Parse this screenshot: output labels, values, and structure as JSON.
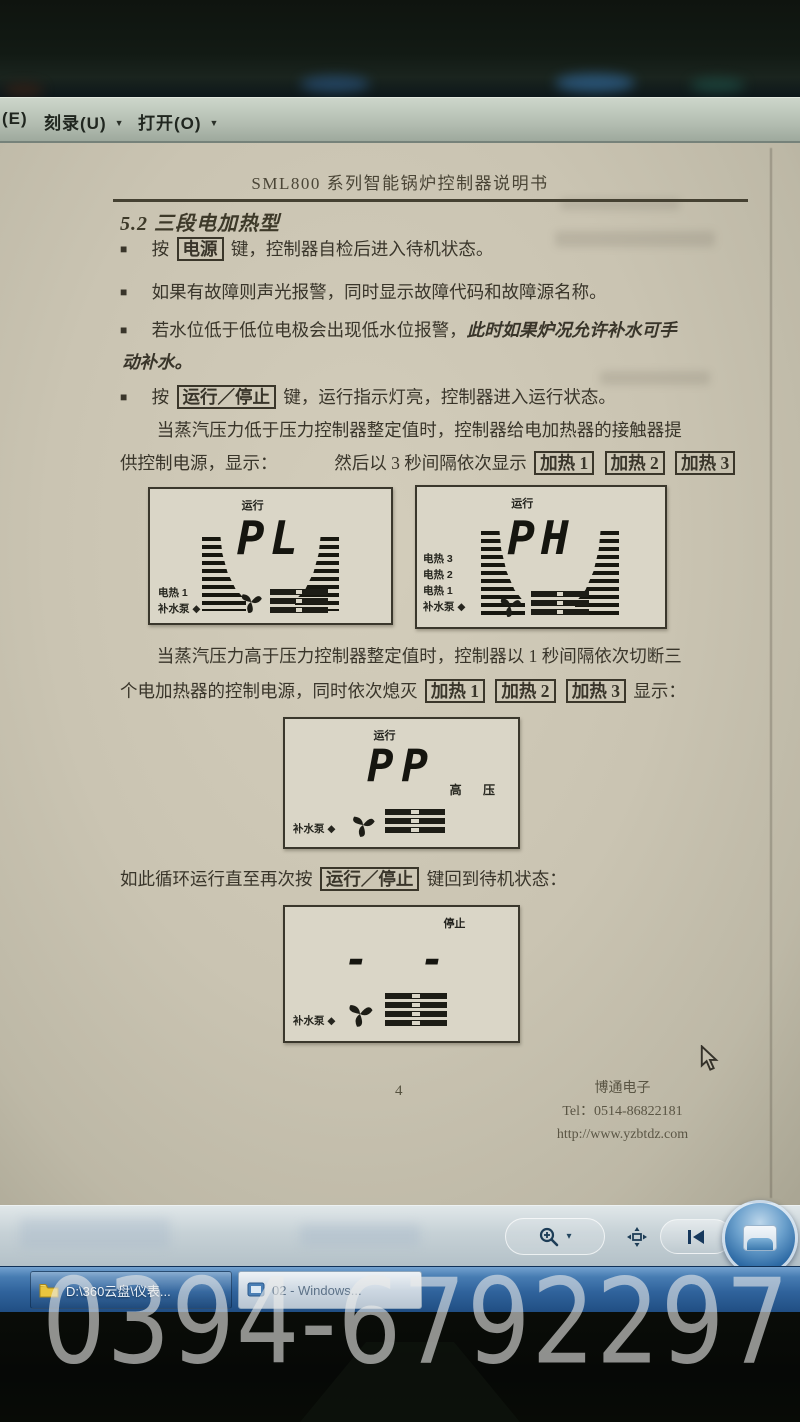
{
  "watermark": {
    "text": "0394-6792297"
  },
  "menu_bar": {
    "edge_item": "(E)",
    "caret": "▼",
    "items": [
      {
        "label": "刻录(U)"
      },
      {
        "label": "打开(O)"
      }
    ]
  },
  "document": {
    "bullet_marker": "■",
    "header_title": "SML800 系列智能锅炉控制器说明书",
    "section_heading": "5.2 三段电加热型",
    "bullets": [
      {
        "pre": "按",
        "key": "电源",
        "post": "键，控制器自检后进入待机状态。"
      },
      {
        "text": "如果有故障则声光报警，同时显示故障代码和故障源名称。"
      },
      {
        "text": "若水位低于低位电极会出现低水位报警，",
        "emph1": "此时如果炉况允许补水可手",
        "emph2": "动补水。"
      },
      {
        "pre": "按",
        "key": "运行／停止",
        "post": "键，运行指示灯亮，控制器进入运行状态。"
      }
    ],
    "heat_keys": [
      "加热 1",
      "加热 2",
      "加热 3"
    ],
    "para1": {
      "line1": "当蒸汽压力低于压力控制器整定值时，控制器给电加热器的接触器提",
      "line2_pre": "供控制电源，显示：",
      "line2_mid": "然后以 3 秒间隔依次显示"
    },
    "para2": {
      "line1": "当蒸汽压力高于压力控制器整定值时，控制器以 1 秒间隔依次切断三",
      "line2_pre": "个电加热器的控制电源，同时依次熄灭",
      "line2_post": "显示："
    },
    "para3": {
      "pre": "如此循环运行直至再次按",
      "key": "运行／停止",
      "post": "键回到待机状态："
    },
    "figures": {
      "fig_pl": {
        "status": "运行",
        "value": "PL",
        "indicators": [
          "电热 1",
          "补水泵 ◆"
        ]
      },
      "fig_ph": {
        "status": "运行",
        "value": "PH",
        "indicators": [
          "电热 3",
          "电热 2",
          "电热 1",
          "补水泵 ◆"
        ]
      },
      "fig_pp": {
        "status": "运行",
        "value": "PP",
        "right_label": "高 压",
        "indicators": [
          "补水泵 ◆"
        ]
      },
      "fig_stop": {
        "status": "停止",
        "value": "- -",
        "indicators": [
          "补水泵 ◆"
        ]
      }
    },
    "footer": {
      "page_number": "4",
      "company": "博通电子",
      "tel": "Tel：0514-86822181",
      "url": "http://www.yzbtdz.com"
    }
  },
  "viewer_toolbar": {
    "caret": "▾"
  },
  "taskbar": {
    "buttons": [
      {
        "label": "D:\\360云盘\\仪表..."
      },
      {
        "label": "02 - Windows..."
      }
    ]
  },
  "colors": {
    "taskbar_blue": "#30639c",
    "page_beige": "#cac4b2",
    "menubar_grey_green": "#b3bdb1",
    "lcd_background": "#dad6c7",
    "ink": "#39352a"
  }
}
